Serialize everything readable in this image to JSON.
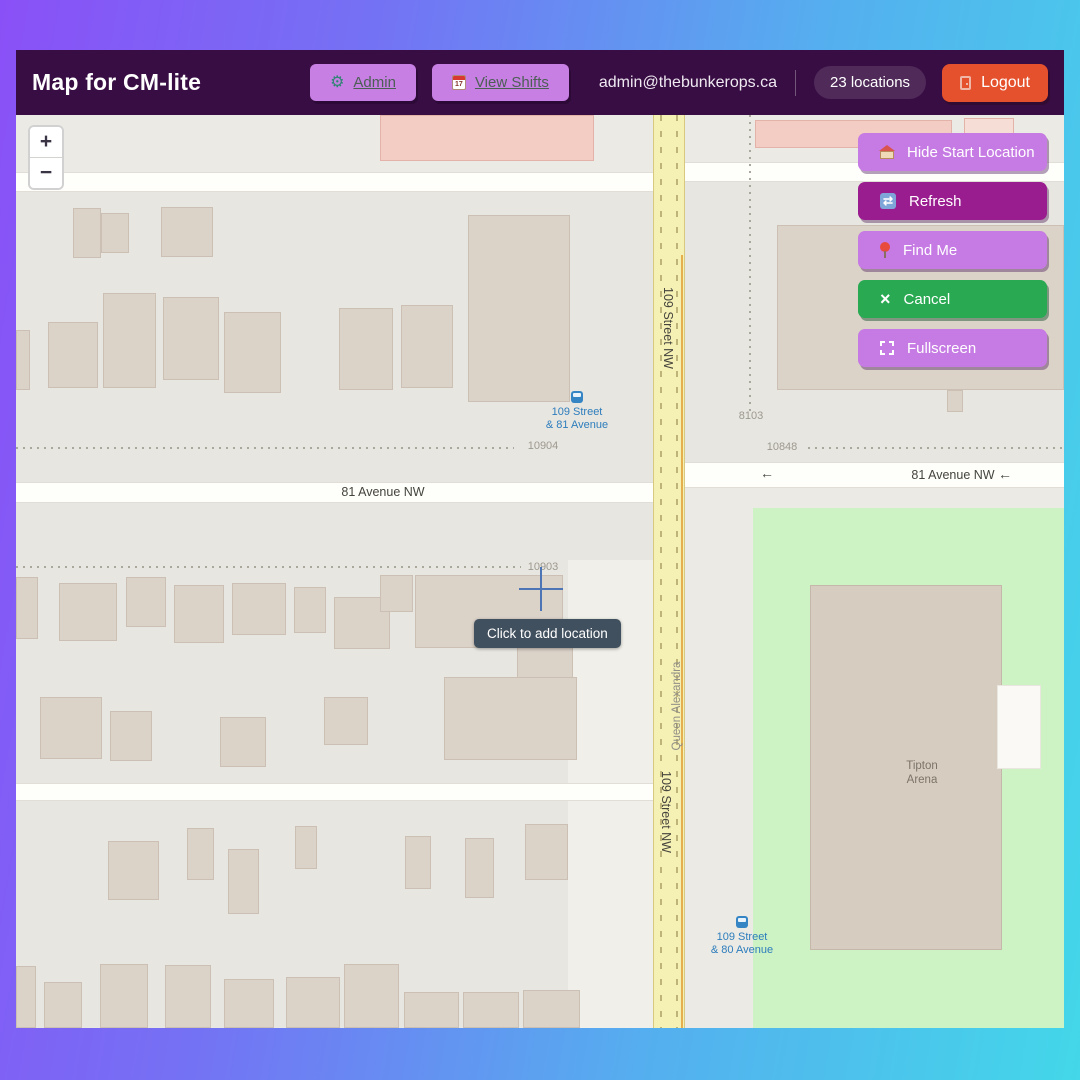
{
  "header": {
    "title": "Map for CM-lite",
    "admin_label": "Admin",
    "gear_glyph": "⚙",
    "view_shifts_label": "View Shifts",
    "calendar_day": "17",
    "email": "admin@thebunkerops.ca",
    "locations_badge": "23 locations",
    "logout_label": "Logout"
  },
  "zoom_control": {
    "zoom_in": "+",
    "zoom_out": "−"
  },
  "actions": {
    "hide_start_label": "Hide Start Location",
    "refresh_label": "Refresh",
    "refresh_glyph": "⇄",
    "find_me_label": "Find Me",
    "cancel_label": "Cancel",
    "cancel_glyph": "×",
    "fullscreen_label": "Fullscreen"
  },
  "map": {
    "tooltip": "Click to add location",
    "street_109_top": "109 Street NW",
    "street_109_bottom": "109 Street NW",
    "avenue_81_left": "81 Avenue NW",
    "avenue_81_right": "81 Avenue NW",
    "oneway_arrow": "←",
    "neighbourhood": "Queen Alexandra",
    "house_10904": "10904",
    "house_10903": "10903",
    "house_10848": "10848",
    "house_8103": "8103",
    "bus_top_line1": "109 Street",
    "bus_top_line2": "& 81 Avenue",
    "bus_bottom_line1": "109 Street",
    "bus_bottom_line2": "& 80 Avenue",
    "arena_line1": "Tipton",
    "arena_line2": "Arena"
  },
  "colors": {
    "frame_gradient_start": "#8a50f7",
    "frame_gradient_end": "#43d7e9",
    "header_bg": "#380d43",
    "button_purple": "#c67ae3",
    "button_magenta": "#9a1d8f",
    "button_green": "#28a952",
    "logout_orange": "#e5512d",
    "road_yellow": "#f5f0b4",
    "park_green": "#cdf2c4"
  }
}
